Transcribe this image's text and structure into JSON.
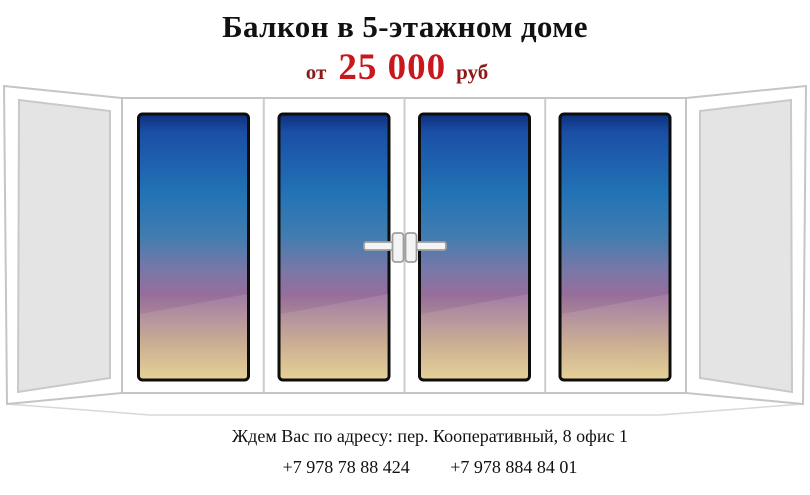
{
  "header": {
    "title": "Балкон в 5-этажном доме",
    "price_prefix": "от",
    "price_value": "25 000",
    "price_currency": "руб"
  },
  "footer": {
    "address": "Ждем Вас по адресу: пер. Кооперативный, 8 офис 1",
    "phone_1": "+7 978 78 88 424",
    "phone_2": "+7 978 884 84 01"
  },
  "illustration": {
    "sash_count": 4,
    "glass_gradient": [
      {
        "offset": "0%",
        "color": "#0E2F7C"
      },
      {
        "offset": "7%",
        "color": "#1A4FA6"
      },
      {
        "offset": "30%",
        "color": "#2273B5"
      },
      {
        "offset": "46%",
        "color": "#417CB0"
      },
      {
        "offset": "58%",
        "color": "#7678A8"
      },
      {
        "offset": "68%",
        "color": "#976E9C"
      },
      {
        "offset": "76%",
        "color": "#AB8694"
      },
      {
        "offset": "86%",
        "color": "#C4A487"
      },
      {
        "offset": "100%",
        "color": "#E3CD8C"
      }
    ],
    "side_glass_fill": "#E4E4E4",
    "frame_line_color": "#C5C5C5",
    "glass_border_color": "#0D0D0D"
  },
  "colors": {
    "price_value": "#C8171D",
    "price_label": "#8B1A1A",
    "text": "#111111"
  }
}
